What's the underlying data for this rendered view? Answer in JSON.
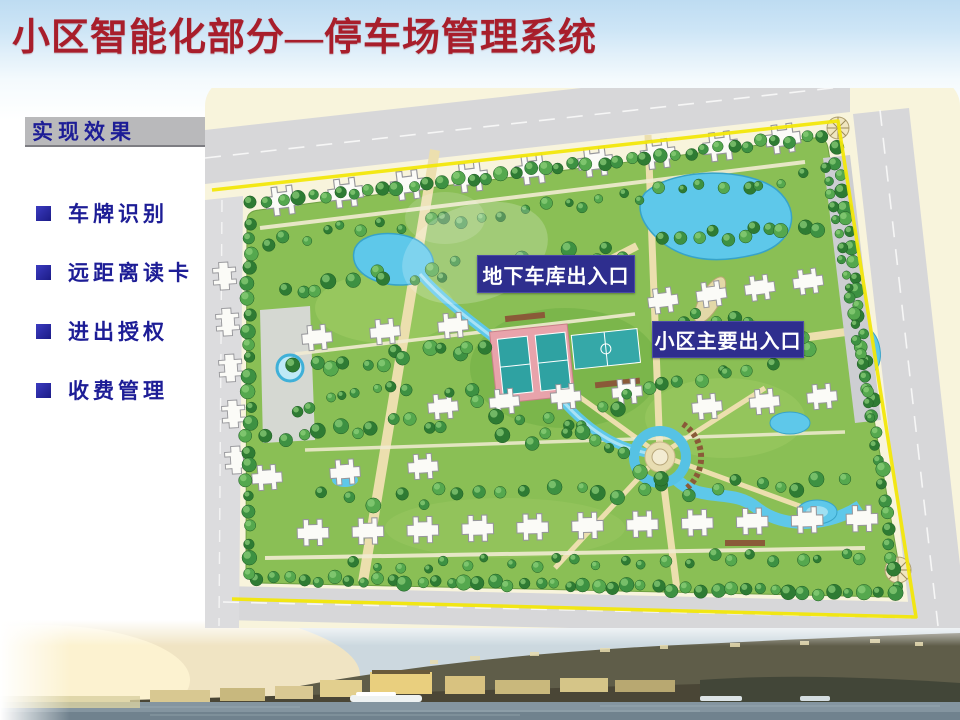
{
  "slide": {
    "title": "小区智能化部分—停车场管理系统"
  },
  "sidebar": {
    "header": "实现效果",
    "items": [
      {
        "label": "车牌识别"
      },
      {
        "label": "远距离读卡"
      },
      {
        "label": "进出授权"
      },
      {
        "label": "收费管理"
      }
    ]
  },
  "map": {
    "labels": {
      "garage": "地下车库出入口",
      "main_entrance": "小区主要出入口"
    },
    "colors": {
      "boundary_yellow": "#f2e70a",
      "label_bg": "#2e2e8e",
      "label_text": "#ffffff"
    }
  },
  "theme": {
    "title_color": "#a81e2b",
    "text_navy": "#1d1d96",
    "header_bar_bg": "#b9b9bb"
  }
}
